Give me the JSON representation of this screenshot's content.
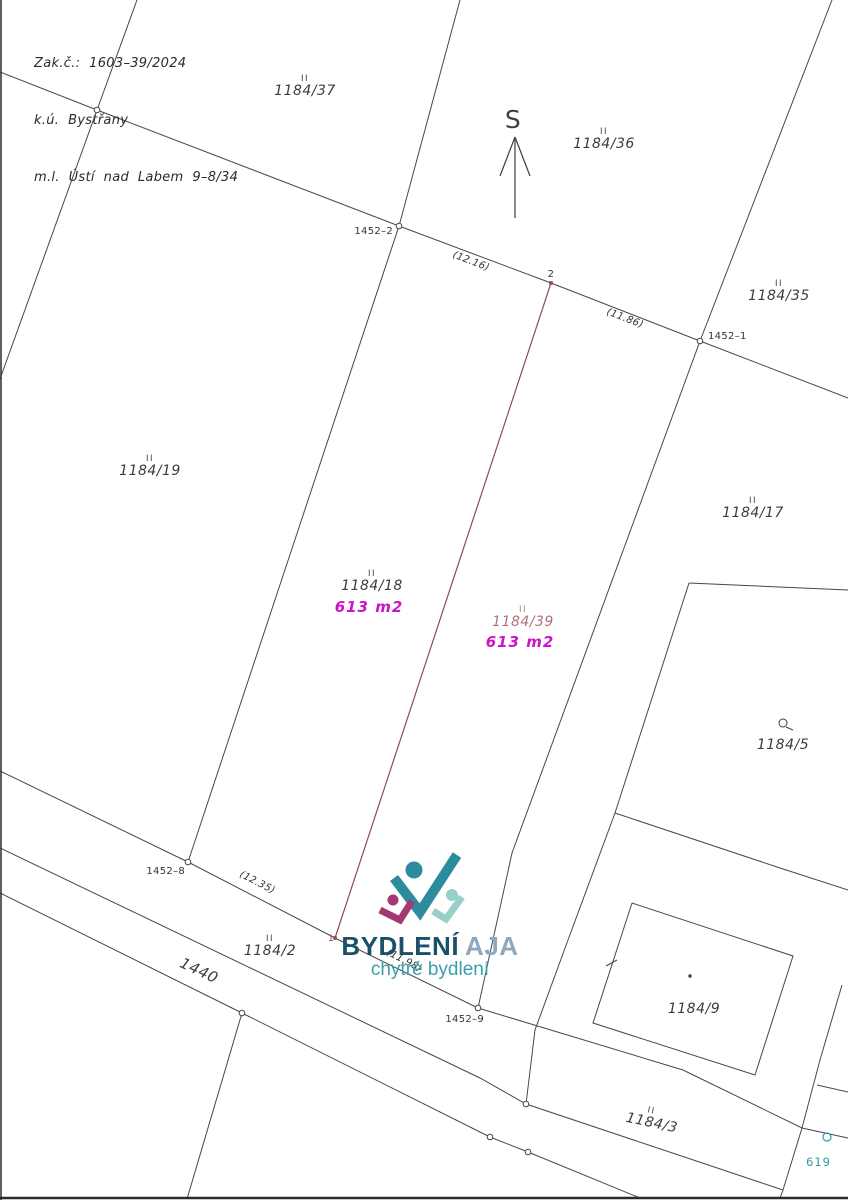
{
  "header": {
    "lines": [
      "Zak.č.:  1603–39/2024",
      "k.ú.  Bystřany",
      "m.l.  Ústí  nad  Labem  9–8/34"
    ]
  },
  "logo": {
    "brand_bold": "BYDLENÍ",
    "brand_light": "AJA",
    "tagline": "chytré bydlení"
  },
  "map_ref": {
    "text": "619"
  },
  "colors": {
    "line": "#474747",
    "frame": "#2b2b2b",
    "ink": "#3c3c3c",
    "point_label": "#333333",
    "new_line": "#8e4a56",
    "rose": "#b0737e",
    "area": "#cb13cb",
    "teal": "#2f9ba5",
    "north": "#3f3f3f",
    "logo_teal": "#2d8b9e",
    "logo_magenta": "#a23874",
    "logo_seafoam": "#99cfc9"
  },
  "map": {
    "lines": [
      {
        "n": "boundary-north",
        "p": [
          [
            0,
            72
          ],
          [
            97,
            110
          ],
          [
            399,
            226
          ],
          [
            551,
            283
          ],
          [
            700,
            341
          ],
          [
            848,
            398
          ]
        ]
      },
      {
        "n": "boundary-west-steep",
        "p": [
          [
            137,
            0
          ],
          [
            97,
            110
          ],
          [
            0,
            379
          ]
        ]
      },
      {
        "n": "divider-1184-37-36",
        "p": [
          [
            460,
            0
          ],
          [
            399,
            226
          ]
        ]
      },
      {
        "n": "divider-1184-36-35",
        "p": [
          [
            832,
            0
          ],
          [
            700,
            341
          ]
        ]
      },
      {
        "n": "strip-west-boundary",
        "p": [
          [
            399,
            226
          ],
          [
            188,
            862
          ]
        ]
      },
      {
        "n": "strip-east-boundary",
        "p": [
          [
            700,
            341
          ],
          [
            512,
            853
          ],
          [
            478,
            1008
          ]
        ]
      },
      {
        "n": "parcel2-north-boundary",
        "p": [
          [
            0,
            771
          ],
          [
            188,
            862
          ],
          [
            335,
            938
          ],
          [
            478,
            1008
          ],
          [
            683,
            1070
          ],
          [
            802,
            1128
          ],
          [
            848,
            1138
          ]
        ]
      },
      {
        "n": "road-north-edge",
        "p": [
          [
            0,
            848
          ],
          [
            480,
            1078
          ],
          [
            526,
            1104
          ],
          [
            783,
            1190
          ]
        ]
      },
      {
        "n": "road-south-edge",
        "p": [
          [
            0,
            893
          ],
          [
            242,
            1013
          ],
          [
            490,
            1137
          ],
          [
            528,
            1152
          ],
          [
            640,
            1198
          ]
        ]
      },
      {
        "n": "below-road-steep",
        "p": [
          [
            242,
            1013
          ],
          [
            187,
            1199
          ]
        ]
      },
      {
        "n": "mid-steep-boundary",
        "p": [
          [
            615,
            813
          ],
          [
            568,
            940
          ],
          [
            535,
            1030
          ],
          [
            526,
            1104
          ]
        ]
      },
      {
        "n": "parcel5-top-edge",
        "p": [
          [
            689,
            583
          ],
          [
            848,
            590
          ]
        ]
      },
      {
        "n": "parcel5-west-edge",
        "p": [
          [
            689,
            583
          ],
          [
            615,
            813
          ]
        ]
      },
      {
        "n": "parcel5-south-edge",
        "p": [
          [
            615,
            813
          ],
          [
            777,
            867
          ],
          [
            848,
            890
          ]
        ]
      },
      {
        "n": "building-1184-9-outline",
        "p": [
          [
            632,
            903
          ],
          [
            793,
            956
          ],
          [
            755,
            1075
          ],
          [
            593,
            1023
          ],
          [
            632,
            903
          ]
        ]
      },
      {
        "n": "building-wall-tick",
        "p": [
          [
            606,
            966
          ],
          [
            617,
            960
          ]
        ]
      },
      {
        "n": "right-steep-boundary",
        "p": [
          [
            842,
            985
          ],
          [
            820,
            1060
          ],
          [
            802,
            1128
          ],
          [
            783,
            1190
          ],
          [
            780,
            1198
          ]
        ]
      },
      {
        "n": "right-branch-line",
        "p": [
          [
            817,
            1085
          ],
          [
            848,
            1092
          ]
        ]
      },
      {
        "n": "parcel5-symbol-tail",
        "p": [
          [
            786,
            727
          ],
          [
            793,
            730
          ]
        ]
      },
      {
        "n": "north-arrow-shaft",
        "p": [
          [
            515,
            218
          ],
          [
            515,
            137
          ]
        ],
        "c": "north",
        "w": 1.2
      },
      {
        "n": "north-arrow-barb-left",
        "p": [
          [
            515,
            137
          ],
          [
            500,
            176
          ]
        ],
        "c": "north",
        "w": 1.2
      },
      {
        "n": "north-arrow-barb-right",
        "p": [
          [
            515,
            137
          ],
          [
            530,
            176
          ]
        ],
        "c": "north",
        "w": 1.2
      },
      {
        "n": "new-division-line",
        "p": [
          [
            551,
            283
          ],
          [
            335,
            938
          ]
        ],
        "c": "new_line",
        "w": 1.2
      },
      {
        "n": "frame-bottom",
        "p": [
          [
            0,
            1198
          ],
          [
            848,
            1198
          ]
        ],
        "c": "frame",
        "w": 2.5
      },
      {
        "n": "frame-left",
        "p": [
          [
            1,
            0
          ],
          [
            1,
            1200
          ]
        ],
        "c": "frame",
        "w": 1.5
      }
    ],
    "vertices": [
      [
        97,
        110
      ],
      [
        399,
        226
      ],
      [
        700,
        341
      ],
      [
        188,
        862
      ],
      [
        478,
        1008
      ],
      [
        242,
        1013
      ],
      [
        526,
        1104
      ],
      [
        490,
        1137
      ],
      [
        528,
        1152
      ]
    ],
    "teal_vertex": {
      "x": 827,
      "y": 1137,
      "r": 4
    },
    "parcel5_symbol": {
      "x": 783,
      "y": 723,
      "r": 4
    },
    "building_dot": {
      "x": 690,
      "y": 976,
      "r": 1.7
    },
    "new_endpoints": [
      [
        551,
        283
      ],
      [
        335,
        938
      ]
    ],
    "parcel_labels": [
      {
        "text": "1184/37",
        "x": 305,
        "y": 95
      },
      {
        "text": "1184/36",
        "x": 604,
        "y": 148
      },
      {
        "text": "1184/35",
        "x": 779,
        "y": 300
      },
      {
        "text": "1184/19",
        "x": 150,
        "y": 475
      },
      {
        "text": "1184/18",
        "x": 372,
        "y": 590
      },
      {
        "text": "1184/39",
        "x": 523,
        "y": 626,
        "color": "rose"
      },
      {
        "text": "1184/17",
        "x": 753,
        "y": 517
      },
      {
        "text": "1184/5",
        "x": 783,
        "y": 749,
        "marker": "none"
      },
      {
        "text": "1184/2",
        "x": 270,
        "y": 955
      },
      {
        "text": "1184/9",
        "x": 694,
        "y": 1013,
        "marker": "none"
      },
      {
        "text": "1184/3",
        "x": 651,
        "y": 1127,
        "rotate": 12
      },
      {
        "text": "1440",
        "x": 197,
        "y": 975,
        "rotate": 25,
        "size": 15,
        "marker": "none"
      }
    ],
    "area_labels": [
      {
        "text": "613 m2",
        "x": 369,
        "y": 612
      },
      {
        "text": "613 m2",
        "x": 520,
        "y": 647
      }
    ],
    "point_labels": [
      {
        "text": "1452–2",
        "x": 393,
        "y": 234,
        "anchor": "end"
      },
      {
        "text": "1452–1",
        "x": 708,
        "y": 339,
        "anchor": "start"
      },
      {
        "text": "1452–8",
        "x": 185,
        "y": 874,
        "anchor": "end"
      },
      {
        "text": "1452–9",
        "x": 484,
        "y": 1022,
        "anchor": "end"
      },
      {
        "text": "2",
        "x": 551,
        "y": 277,
        "anchor": "middle"
      },
      {
        "text": "1",
        "x": 331,
        "y": 941,
        "anchor": "middle",
        "color": "new_line",
        "size": 9
      }
    ],
    "dim_labels": [
      {
        "text": "(12.16)",
        "x": 470,
        "y": 264,
        "rotate": 21
      },
      {
        "text": "(11.86)",
        "x": 624,
        "y": 321,
        "rotate": 21
      },
      {
        "text": "(12.35)",
        "x": 256,
        "y": 885,
        "rotate": 27
      },
      {
        "text": "(11.98)",
        "x": 403,
        "y": 963,
        "rotate": 27
      }
    ],
    "north_label": {
      "text": "S",
      "x": 513,
      "y": 128,
      "size": 25
    }
  }
}
